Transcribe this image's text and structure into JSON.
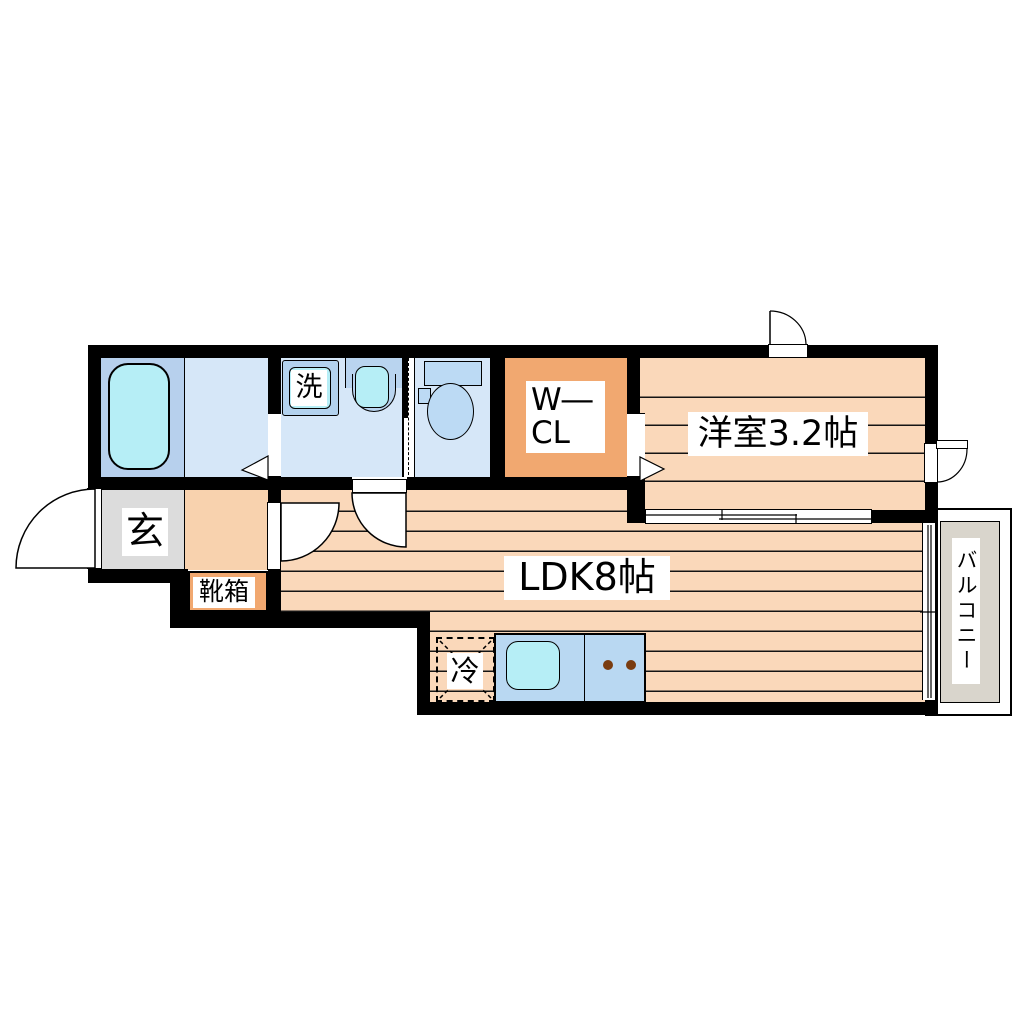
{
  "floorplan": {
    "rooms": {
      "washroom": {
        "appliance_label": "洗"
      },
      "walk_in_closet": {
        "label_line1": "W―",
        "label_line2": "CL"
      },
      "western_room": {
        "label": "洋室3.2帖"
      },
      "entrance": {
        "label": "玄"
      },
      "shoe_box": {
        "label": "靴箱"
      },
      "ldk": {
        "label": "LDK8帖"
      },
      "kitchen": {
        "fridge_label": "冷"
      },
      "balcony": {
        "label": "バルコニー"
      }
    },
    "colors": {
      "wall": "#000000",
      "wood_floor": "#fad8ba",
      "hall_floor": "#f8d2ae",
      "closet_orange": "#f1a870",
      "entrance_gray": "#dcdcdc",
      "balcony_gray": "#d9d5cc",
      "wet_room_blue": "#d6e7f8",
      "bath_blue": "#b7d0ed",
      "fixture_blue": "#b9d4ef",
      "water_cyan": "#b6eef6",
      "burner_brown": "#7a3c10"
    }
  }
}
